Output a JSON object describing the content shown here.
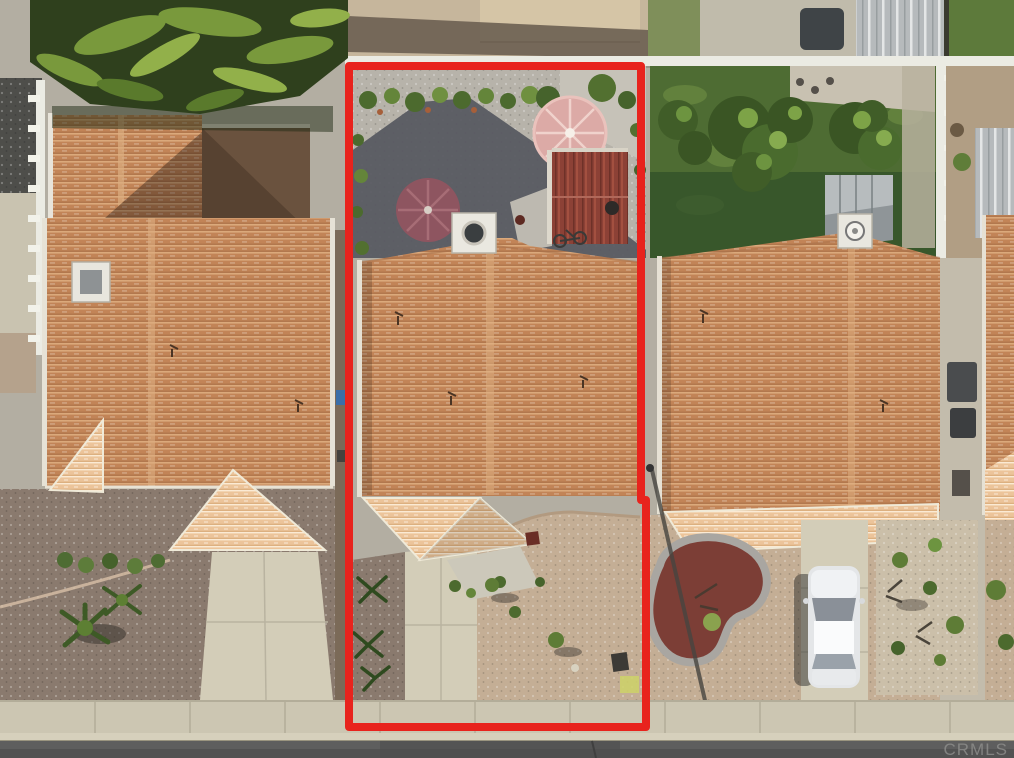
{
  "photo": {
    "kind": "aerial-real-estate-listing-photo",
    "width": 1014,
    "height": 758,
    "subject": "center lot outlined in red: house with terracotta tile roof, gravel backyard with two patio umbrellas and red-roof shed, desert-landscaped front yard, flanked by two similar tile-roof homes, street and sidewalk at bottom"
  },
  "watermark": {
    "text": "CRMLS",
    "color": "#8f8f8d"
  },
  "outline": {
    "color": "#e8231d",
    "stroke_width": 8
  },
  "palette": {
    "tile_roof": "#c28457",
    "tile_roof_light": "#ecc49a",
    "umbrella_pink": "#dcaaa6",
    "umbrella_maroon": "#8e5560",
    "shed_red": "#8c4136",
    "lawn": "#4e6c33",
    "mulch_red": "#7c3e36",
    "car_body": "#e4e6e8",
    "backyard_gravel": "#b7b3aa",
    "shadow": "#565860",
    "front_gravel_left": "#8a7a6e",
    "front_gravel_tan": "#c4ae95",
    "concrete": "#d3cdb8",
    "sidewalk": "#ccc6b2",
    "street": "#5e5e5e",
    "fence_white": "#ebebe3",
    "metal_roof": "#b6babc"
  }
}
